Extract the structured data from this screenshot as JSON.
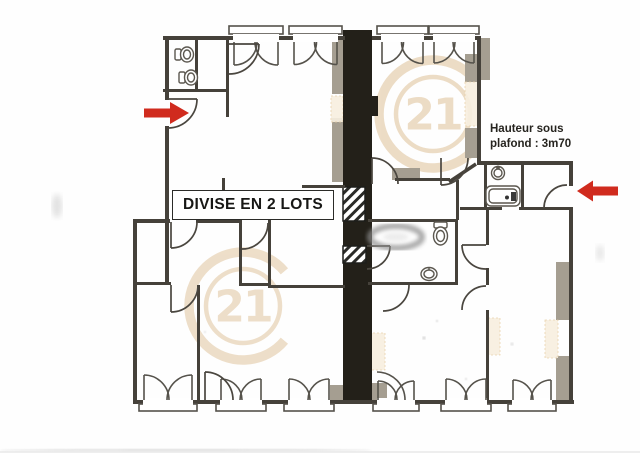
{
  "page": {
    "division_label": "DIVISE EN 2 LOTS",
    "ceiling_note": {
      "line1": "Hauteur sous",
      "line2": "plafond : 3m70"
    },
    "watermark": {
      "text": "21"
    }
  },
  "colors": {
    "wall": "#45413a",
    "shaft": "#232019",
    "arrow_red": "#d02b1e",
    "watermark_tan": "#ead7bc",
    "block_gray": "#a59e91",
    "cream_patch": "#f8efe0"
  }
}
